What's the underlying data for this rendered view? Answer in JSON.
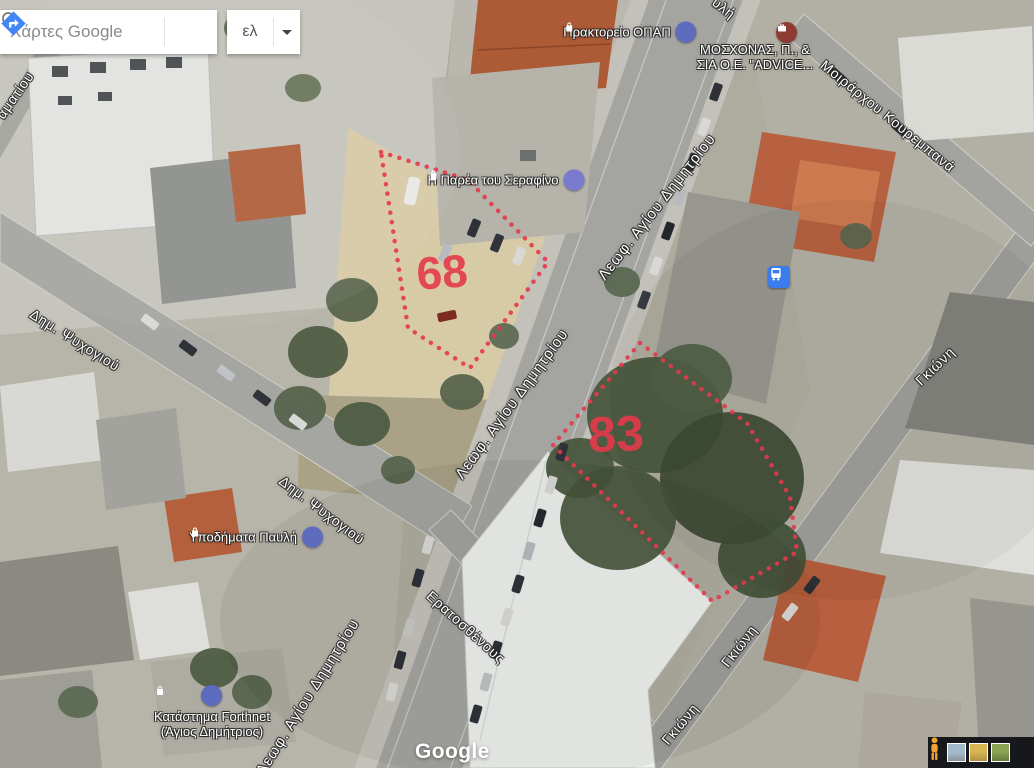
{
  "map": {
    "search": {
      "query": "Χάρτες Google",
      "language": "ελ"
    },
    "watermark": "Google",
    "plots": {
      "plot68": "68",
      "plot83": "83"
    },
    "streets": {
      "avenue": "Λεωφ. Αγίου Δημητρίου",
      "psychogiou": "Δημ. Ψυχογιού",
      "eratosthenous": "Ερατοσθένους",
      "kourempana": "Μοιράρχου Κουρεμπανά",
      "gkioni": "Γκιώνη",
      "left_edge_fragment": "αματίου",
      "top_edge_fragment": "υλή"
    },
    "pois": {
      "opap": {
        "label": "Πρακτορείο ΟΠΑΠ"
      },
      "moschonas": {
        "line1": "ΜΟΣΧΟΝΑΣ, Π., &",
        "line2": "ΣΙΑ Ο.Ε. \"ADVICE..."
      },
      "serafino": {
        "label": "Η Παρέα του Σεραφίνο"
      },
      "pavli": {
        "label": "Υποδήματα Παυλή"
      },
      "forthnet": {
        "line1": "Κατάστημα Forthnet",
        "line2": "(Άγιος Δημήτριος)"
      }
    },
    "icons": {
      "search": "magnifier-icon",
      "directions": "directions-diamond-icon",
      "language_dropdown": "caret-down-icon",
      "shopping": "shopping-bag-icon",
      "business": "briefcase-icon",
      "transit": "bus-stop-icon",
      "street_view": "pegman-icon"
    },
    "colors": {
      "plot_outline": "#e5394b",
      "directions_blue": "#4285f4",
      "poi_icon_purple": "#5e6cc0",
      "poi_icon_maroon": "#8d3b33",
      "transit_blue": "#3a7cec",
      "pegman_orange": "#f0a32e"
    }
  }
}
